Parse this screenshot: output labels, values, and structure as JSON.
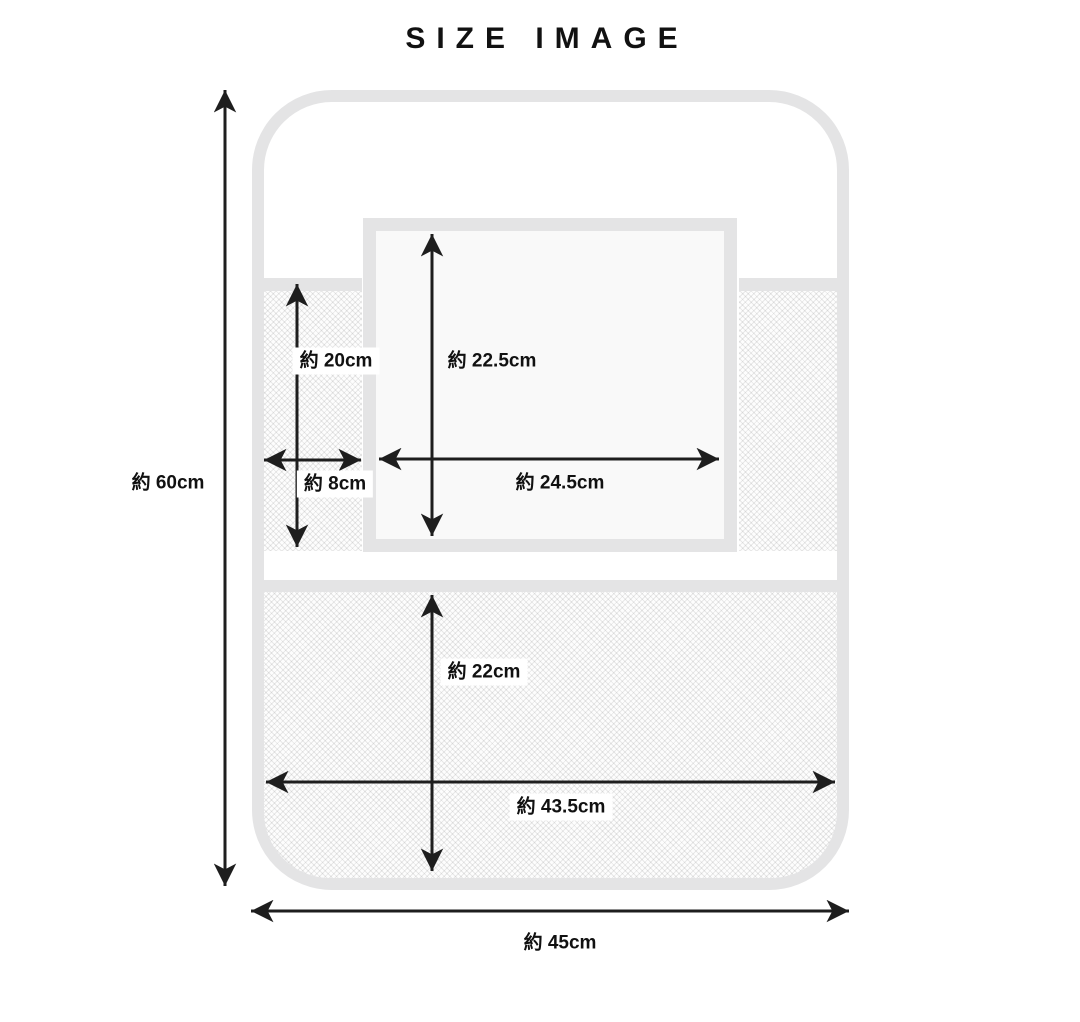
{
  "title": "SIZE IMAGE",
  "diagram": {
    "product": "seat-back organizer size diagram",
    "labels": {
      "total_height": "約 60cm",
      "total_width": "約 45cm",
      "side_pocket_height": "約 20cm",
      "side_pocket_width": "約 8cm",
      "center_pocket_height": "約 22.5cm",
      "center_pocket_width": "約 24.5cm",
      "bottom_pocket_height": "約 22cm",
      "bottom_pocket_width": "約 43.5cm"
    },
    "colors": {
      "outline_gray": "#e4e4e5",
      "arrow_black": "#1e1e1e",
      "text_black": "#111111",
      "pocket_fill": "#f9f9f9"
    }
  }
}
